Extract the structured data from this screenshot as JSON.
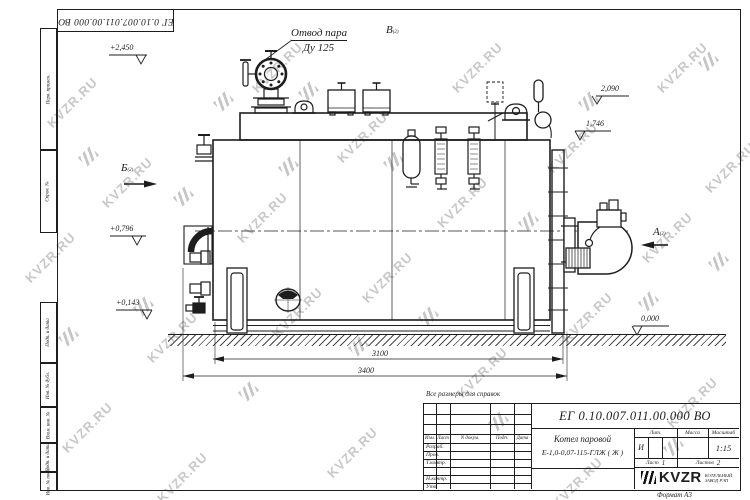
{
  "sheet": {
    "doc_number": "ЕГ 0.10.007.011.00.000  ВО",
    "watermark_text": "KVZR.RU",
    "reference_note": "Все размеры для справок",
    "format_note": "Формат А3"
  },
  "margin": [
    "Перв. примен.",
    "Справ. №",
    "Подп. и дата",
    "Инв. № дубл.",
    "Взам. инв. №",
    "Подп. и дата",
    "Инв. № подл."
  ],
  "annotations": {
    "steam_label_line1": "Отвод пара",
    "steam_label_line2": "Ду 125",
    "view_b": "Б",
    "view_v": "В",
    "view_a": "А",
    "view_sheet_ref": "(2)",
    "elev_top": "+2,450",
    "elev_2090": "2,090",
    "elev_1746": "1,746",
    "elev_0796": "+0,796",
    "elev_0143": "+0,143",
    "elev_zero": "0,000",
    "dim_inner": "3100",
    "dim_overall": "3400"
  },
  "title_block": {
    "doc_number": "ЕГ 0.10.007.011.00.000  ВО",
    "product_line1": "Котел паровой",
    "product_line2": "Е-1,0-0,07-115-ГЛЖ ( Ж )",
    "col_izm": "Изм.",
    "col_list": "Лист",
    "col_ndoc": "N докум.",
    "col_podp": "Подп.",
    "col_data": "Дата",
    "row_razrab": "Разраб.",
    "row_prov": "Пров.",
    "row_tkontr": "Т.контр.",
    "row_nkontr": "Н.контр.",
    "row_utv": "Утв.",
    "lit_label": "Лит.",
    "lit_value": "И",
    "mass_label": "Масса",
    "scale_label": "Масштаб",
    "scale_value": "1:15",
    "sheet_label": "Лист",
    "sheet_value": "1",
    "sheets_label": "Листов",
    "sheets_value": "2",
    "logo_text": "KVZR",
    "logo_sub1": "КОТЕЛЬНЫЙ",
    "logo_sub2": "ЗАВОД РЭП"
  }
}
